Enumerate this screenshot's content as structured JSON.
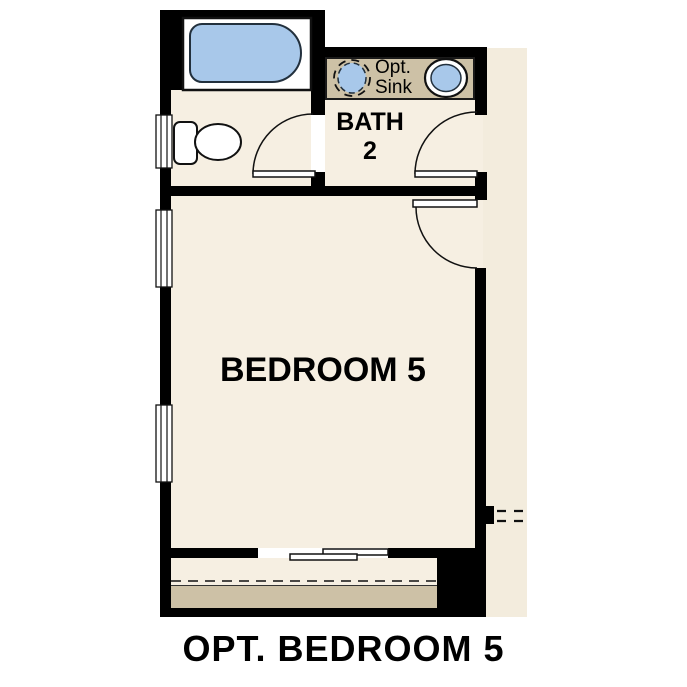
{
  "caption": {
    "text": "OPT. BEDROOM 5"
  },
  "rooms": {
    "bath": {
      "label": "BATH",
      "number": "2"
    },
    "bedroom": {
      "label": "BEDROOM 5"
    }
  },
  "fixtures": {
    "optional_sink_label": {
      "line1": "Opt.",
      "line2": "Sink"
    }
  },
  "colors": {
    "floor": "#f6efe2",
    "hallway": "#f3ecdd",
    "counter": "#cdc1a6",
    "blue": "#a8c8ea",
    "wall": "#000000",
    "line": "#111111"
  }
}
